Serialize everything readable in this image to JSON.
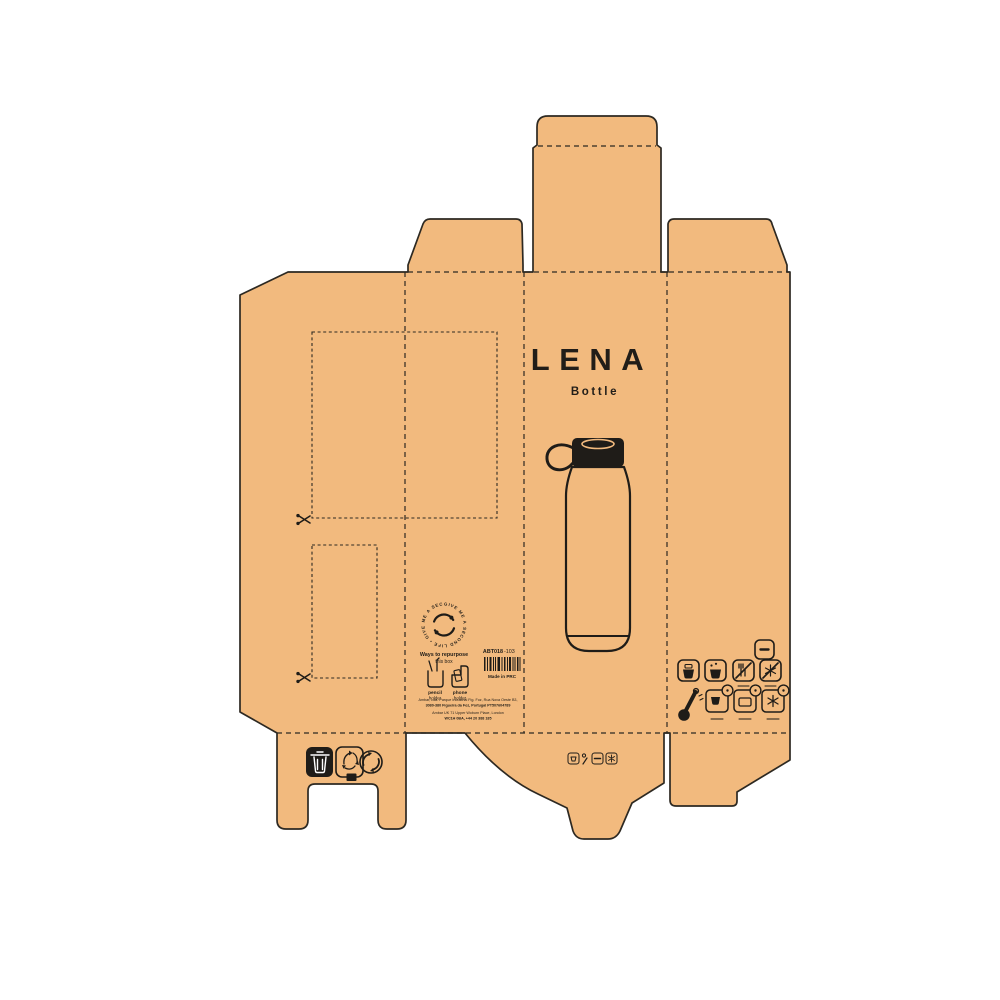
{
  "colors": {
    "kraft": "#f2ba7e",
    "outline": "#2d2922",
    "ink": "#1f1c18",
    "background": "#ffffff"
  },
  "front_panel": {
    "title": "LENA",
    "subtitle": "Bottle"
  },
  "repurpose": {
    "circle_text": "GIVE ME A SECOND LIFE • GIVE ME A SECOND LIFE •",
    "heading_line1": "Ways to repurpose",
    "heading_line2": "this box",
    "items": [
      {
        "label": "pencil",
        "sublabel": "holder"
      },
      {
        "label": "phone",
        "sublabel": "holder"
      }
    ]
  },
  "product": {
    "sku_prefix": "ABT018",
    "sku_suffix": "-103",
    "origin": "Made in PRC",
    "paper_code": "21"
  },
  "address": {
    "line1": "Ambar, Lda. Parque Industrial Fig. Foz, Rua Nova Oeste B3,",
    "line2": "3080-380 Figueira da Foz, Portugal PT507604789",
    "line3": "Ambar UK 71 Upper Woburn Place, London",
    "line4": "WC1H 0BA, +44 20 388 185"
  },
  "icon_names": {
    "care_panel": [
      "capacity-icon",
      "hot-drink-icon",
      "cold-drink-icon",
      "hand-wash-only-icon",
      "no-frost-icon",
      "thermometer-icon",
      "keeps-hot-icon",
      "keeps-cold-icon",
      "keeps-frost-icon"
    ],
    "recycling": [
      "waste-bin-icon",
      "paper-recycle-icon",
      "green-dot-icon"
    ],
    "mini_care": [
      "mini-wash-icon",
      "mini-temp-icon",
      "mini-capacity-icon",
      "mini-frost-icon"
    ],
    "repurpose": [
      "pencil-holder-icon",
      "phone-holder-icon"
    ],
    "marks": [
      "cut-mark-scissors",
      "barcode",
      "second-life-badge"
    ]
  }
}
